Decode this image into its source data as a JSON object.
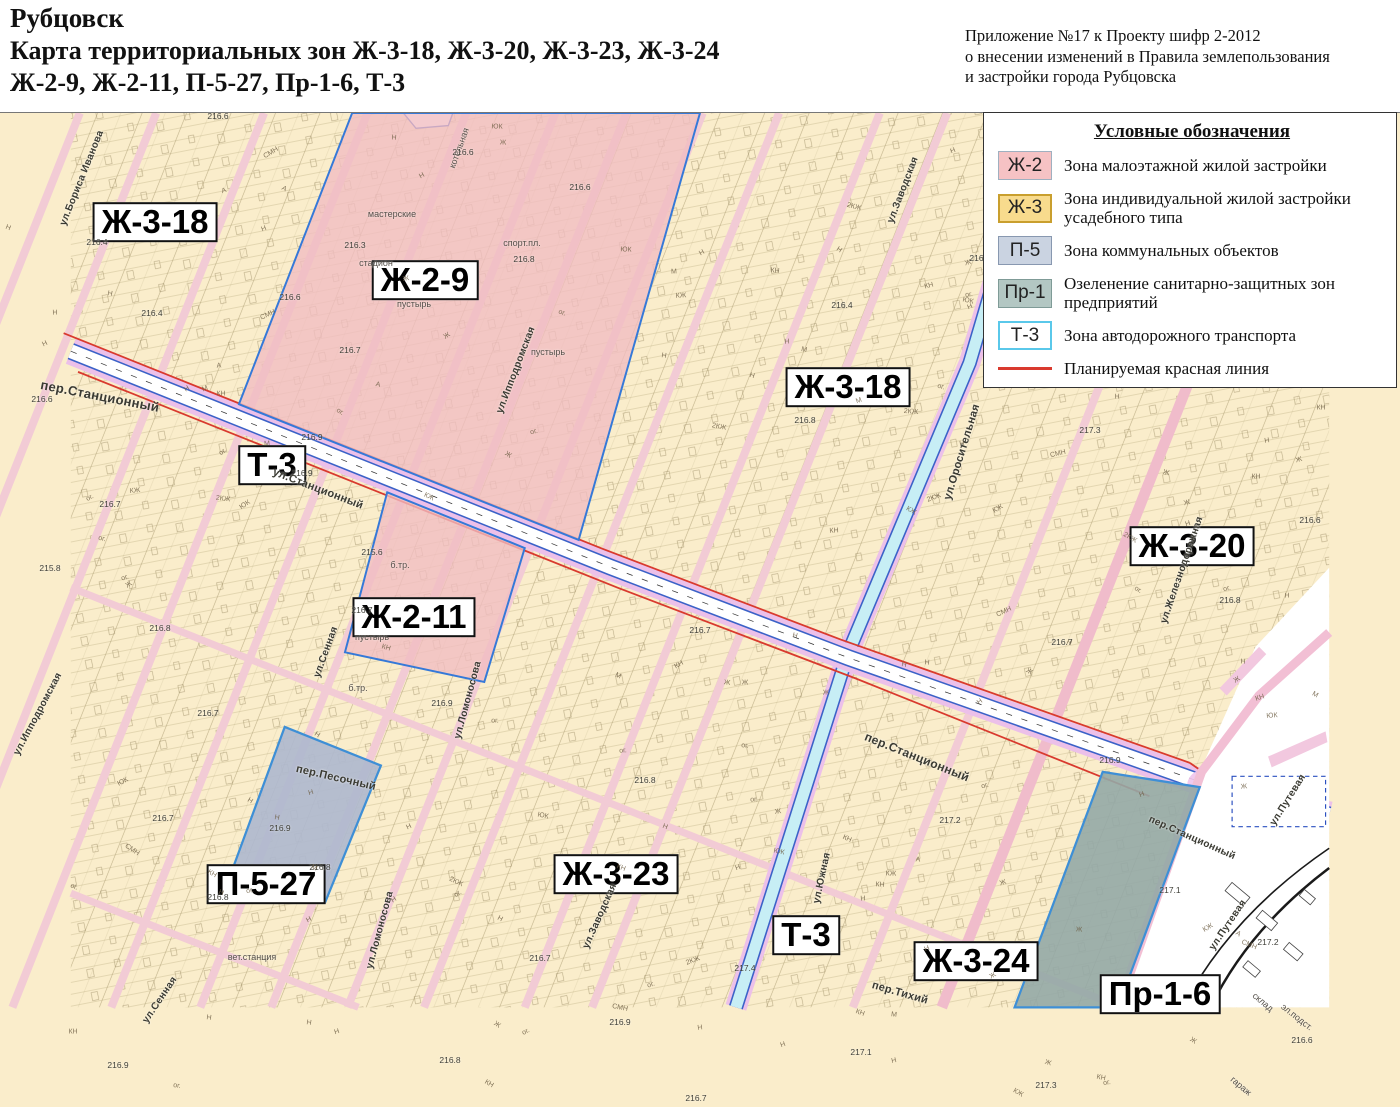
{
  "header": {
    "title_line1": "Рубцовск",
    "title_line2": "Карта территориальных зон Ж-3-18, Ж-3-20, Ж-3-23, Ж-3-24",
    "title_line3": "Ж-2-9, Ж-2-11, П-5-27, Пр-1-6, Т-3",
    "annotation_line1": "Приложение №17 к Проекту шифр 2-2012",
    "annotation_line2": "о внесении изменений в Правила землепользования",
    "annotation_line3": "и застройки города Рубцовска"
  },
  "legend": {
    "title": "Условные обозначения",
    "items": [
      {
        "key": "Ж-2",
        "label": "Зона малоэтажной жилой застройки",
        "swatch_bg": "#F6C2C4",
        "swatch_border": "#9FB0C0"
      },
      {
        "key": "Ж-3",
        "label": "Зона индивидуальной жилой застройки усадебного типа",
        "swatch_bg": "#F8DB8D",
        "swatch_border": "#C99F2E"
      },
      {
        "key": "П-5",
        "label": "Зона коммунальных объектов",
        "swatch_bg": "#CAD3E1",
        "swatch_border": "#8898B0"
      },
      {
        "key": "Пр-1",
        "label": "Озеленение санитарно-защитных зон предприятий",
        "swatch_bg": "#B3C7C3",
        "swatch_border": "#7F9B97"
      },
      {
        "key": "Т-3",
        "label": "Зона автодорожного транспорта",
        "swatch_bg": "#FFFFFF",
        "swatch_border": "#5AC8EA"
      },
      {
        "key": "red-line",
        "label": "Планируемая красная линия",
        "line_color": "#D93A2E"
      }
    ]
  },
  "map": {
    "colors": {
      "zone-yellow": "#FAEDCB",
      "zone-pink": "#F1BCC2",
      "zone-blue": "#AFB9CE",
      "zone-teal": "#93A8A6",
      "road-pink-band": "#ECC0E9",
      "road-blue": "#3B62C8",
      "road-cyan": "#C7EEF5",
      "street-pink": "#F2CBD5",
      "street-salmon": "#F0BCCB",
      "parcel-line": "#A5966A",
      "red-line": "#D93A2E",
      "border-blue": "#3E8FD6"
    },
    "zone_labels": [
      {
        "text": "Ж-3-18",
        "x": 155,
        "y": 222
      },
      {
        "text": "Ж-2-9",
        "x": 425,
        "y": 280
      },
      {
        "text": "Ж-3-18",
        "x": 848,
        "y": 387
      },
      {
        "text": "Т-3",
        "x": 272,
        "y": 465
      },
      {
        "text": "Ж-3-20",
        "x": 1192,
        "y": 546
      },
      {
        "text": "Ж-2-11",
        "x": 414,
        "y": 617
      },
      {
        "text": "П-5-27",
        "x": 266,
        "y": 884
      },
      {
        "text": "Ж-3-23",
        "x": 616,
        "y": 874
      },
      {
        "text": "Т-3",
        "x": 806,
        "y": 935
      },
      {
        "text": "Ж-3-24",
        "x": 976,
        "y": 961
      },
      {
        "text": "Пр-1-6",
        "x": 1160,
        "y": 994
      }
    ],
    "street_labels": [
      {
        "text": "пер.Станционный",
        "x": 100,
        "y": 396,
        "r": 11,
        "size": 13
      },
      {
        "text": "ул.Станционный",
        "x": 318,
        "y": 489,
        "r": 21,
        "size": 11
      },
      {
        "text": "пер.Станционный",
        "x": 917,
        "y": 757,
        "r": 22,
        "size": 12
      },
      {
        "text": "пер.Станционный",
        "x": 1192,
        "y": 838,
        "r": 24,
        "size": 10
      },
      {
        "text": "ул.Оросительная",
        "x": 962,
        "y": 452,
        "r": -73,
        "size": 11
      },
      {
        "text": "ул.Южная",
        "x": 822,
        "y": 878,
        "r": -78,
        "size": 10
      },
      {
        "text": "ул.Заводская",
        "x": 903,
        "y": 190,
        "r": -69,
        "size": 10
      },
      {
        "text": "ул.Заводская",
        "x": 600,
        "y": 916,
        "r": -66,
        "size": 10
      },
      {
        "text": "ул.Ипподромская",
        "x": 516,
        "y": 370,
        "r": -69,
        "size": 10
      },
      {
        "text": "ул.Ипподромская",
        "x": 38,
        "y": 714,
        "r": -62,
        "size": 10
      },
      {
        "text": "ул.Бориса Иванова",
        "x": 82,
        "y": 178,
        "r": -68,
        "size": 10
      },
      {
        "text": "ул.Сенная",
        "x": 326,
        "y": 652,
        "r": -70,
        "size": 10
      },
      {
        "text": "ул.Сенная",
        "x": 160,
        "y": 1000,
        "r": -56,
        "size": 10
      },
      {
        "text": "ул.Ломоносова",
        "x": 468,
        "y": 700,
        "r": -75,
        "size": 10
      },
      {
        "text": "ул.Ломоносова",
        "x": 380,
        "y": 930,
        "r": -75,
        "size": 10
      },
      {
        "text": "ул.Железнодорожная",
        "x": 1182,
        "y": 570,
        "r": -71,
        "size": 10
      },
      {
        "text": "ул.Путевая",
        "x": 1288,
        "y": 800,
        "r": -58,
        "size": 10
      },
      {
        "text": "ул.Путевая",
        "x": 1228,
        "y": 925,
        "r": -56,
        "size": 10
      },
      {
        "text": "пер.Песочный",
        "x": 336,
        "y": 778,
        "r": 13,
        "size": 11
      },
      {
        "text": "пер.Тихий",
        "x": 900,
        "y": 993,
        "r": 16,
        "size": 11
      }
    ],
    "place_labels": [
      {
        "text": "стадион",
        "x": 376,
        "y": 263,
        "r": 0
      },
      {
        "text": "пустырь",
        "x": 414,
        "y": 304,
        "r": 0
      },
      {
        "text": "пустырь",
        "x": 548,
        "y": 352,
        "r": 0
      },
      {
        "text": "пустырь",
        "x": 372,
        "y": 637,
        "r": 0
      },
      {
        "text": "мастерские",
        "x": 392,
        "y": 214,
        "r": 0
      },
      {
        "text": "котельная",
        "x": 459,
        "y": 148,
        "r": -70
      },
      {
        "text": "спорт.пл.",
        "x": 522,
        "y": 243,
        "r": 0
      },
      {
        "text": "вет.станция",
        "x": 252,
        "y": 957,
        "r": 0
      },
      {
        "text": "склад",
        "x": 1263,
        "y": 1002,
        "r": 40
      },
      {
        "text": "эл.подст.",
        "x": 1297,
        "y": 1017,
        "r": 38
      },
      {
        "text": "гараж",
        "x": 1241,
        "y": 1086,
        "r": 40
      },
      {
        "text": "б.тр.",
        "x": 400,
        "y": 565,
        "r": 0
      },
      {
        "text": "б.тр.",
        "x": 358,
        "y": 688,
        "r": 0
      }
    ],
    "elevations": [
      {
        "v": "216.6",
        "x": 218,
        "y": 116
      },
      {
        "v": "216.6",
        "x": 463,
        "y": 152
      },
      {
        "v": "216.6",
        "x": 580,
        "y": 187
      },
      {
        "v": "216.3",
        "x": 355,
        "y": 245
      },
      {
        "v": "216.8",
        "x": 524,
        "y": 259
      },
      {
        "v": "216.6",
        "x": 290,
        "y": 297
      },
      {
        "v": "216.4",
        "x": 152,
        "y": 313
      },
      {
        "v": "216.4",
        "x": 97,
        "y": 242
      },
      {
        "v": "216.7",
        "x": 350,
        "y": 350
      },
      {
        "v": "216.6",
        "x": 42,
        "y": 399
      },
      {
        "v": "216.9",
        "x": 312,
        "y": 437
      },
      {
        "v": "216.9",
        "x": 302,
        "y": 473
      },
      {
        "v": "216.7",
        "x": 110,
        "y": 504
      },
      {
        "v": "215.8",
        "x": 50,
        "y": 568
      },
      {
        "v": "216.8",
        "x": 160,
        "y": 628
      },
      {
        "v": "215.6",
        "x": 372,
        "y": 552
      },
      {
        "v": "216.7",
        "x": 362,
        "y": 610
      },
      {
        "v": "216.9",
        "x": 442,
        "y": 703
      },
      {
        "v": "216.7",
        "x": 208,
        "y": 713
      },
      {
        "v": "216.7",
        "x": 163,
        "y": 818
      },
      {
        "v": "216.9",
        "x": 280,
        "y": 828
      },
      {
        "v": "216.8",
        "x": 320,
        "y": 867
      },
      {
        "v": "216.8",
        "x": 218,
        "y": 897
      },
      {
        "v": "216.8",
        "x": 645,
        "y": 780
      },
      {
        "v": "216.7",
        "x": 700,
        "y": 630
      },
      {
        "v": "216.8",
        "x": 805,
        "y": 420
      },
      {
        "v": "216.8",
        "x": 980,
        "y": 258
      },
      {
        "v": "216.4",
        "x": 842,
        "y": 305
      },
      {
        "v": "217.3",
        "x": 1090,
        "y": 430
      },
      {
        "v": "216.7",
        "x": 1062,
        "y": 642
      },
      {
        "v": "216.8",
        "x": 1230,
        "y": 600
      },
      {
        "v": "216.6",
        "x": 1310,
        "y": 520
      },
      {
        "v": "217.2",
        "x": 950,
        "y": 820
      },
      {
        "v": "217.1",
        "x": 1170,
        "y": 890
      },
      {
        "v": "217.1",
        "x": 861,
        "y": 1052
      },
      {
        "v": "216.9",
        "x": 620,
        "y": 1022
      },
      {
        "v": "216.7",
        "x": 540,
        "y": 958
      },
      {
        "v": "216.8",
        "x": 450,
        "y": 1060
      },
      {
        "v": "216.9",
        "x": 118,
        "y": 1065
      },
      {
        "v": "216.7",
        "x": 696,
        "y": 1098
      },
      {
        "v": "216.6",
        "x": 1302,
        "y": 1040
      },
      {
        "v": "217.3",
        "x": 1046,
        "y": 1085
      },
      {
        "v": "217.2",
        "x": 1268,
        "y": 942
      },
      {
        "v": "216.9",
        "x": 1110,
        "y": 760
      },
      {
        "v": "217.4",
        "x": 745,
        "y": 968
      }
    ],
    "scatter": {
      "glyphs": [
        "Н",
        "Ж",
        "ог.",
        "КН",
        "Н",
        "КЖ",
        "М",
        "ог.",
        "СМН",
        "Н",
        "ЮК",
        "Ж",
        "А",
        "Н",
        "ог.",
        "КН",
        "Н",
        "Ж",
        "2КЖ",
        "Н"
      ],
      "count": 175
    }
  }
}
